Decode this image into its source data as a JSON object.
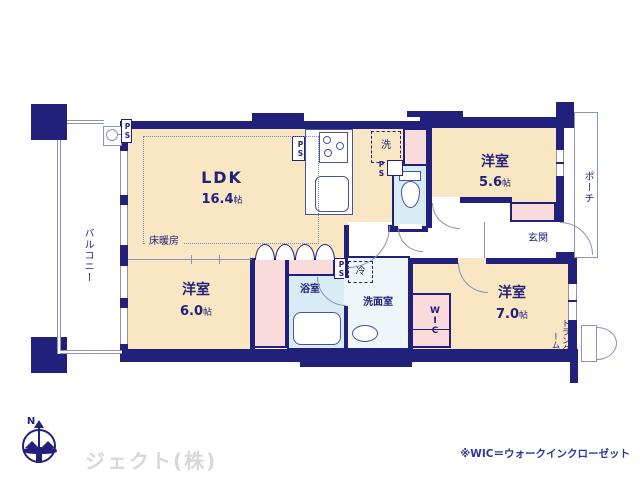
{
  "labels": {
    "ldk_name": "LDK",
    "ldk_size": "16.4",
    "ldk_unit": "帖",
    "r56_name": "洋室",
    "r56_size": "5.6",
    "r56_unit": "帖",
    "r60_name": "洋室",
    "r60_size": "6.0",
    "r60_unit": "帖",
    "r70_name": "洋室",
    "r70_size": "7.0",
    "r70_unit": "帖",
    "balcony": "バルコニー",
    "porch": "ポーチ",
    "genkan": "玄関",
    "bath": "浴室",
    "washroom": "洗面室",
    "wic": "WIC",
    "trunk": "トランクルーム",
    "floor_heating": "床暖房",
    "washer": "洗",
    "fridge": "冷",
    "ps": "PS",
    "north": "N",
    "company": "ジェクト(株)",
    "note": "※WIC＝ウォークインクローゼット"
  },
  "colors": {
    "navy": "#21217b",
    "line": "#8a92b8",
    "beige": "#f8e7c2",
    "pink": "#f8dbda",
    "bath": "#d8ecf5",
    "wash": "#eef6fa",
    "gray": "#d8d8d8",
    "note": "#31319a"
  }
}
